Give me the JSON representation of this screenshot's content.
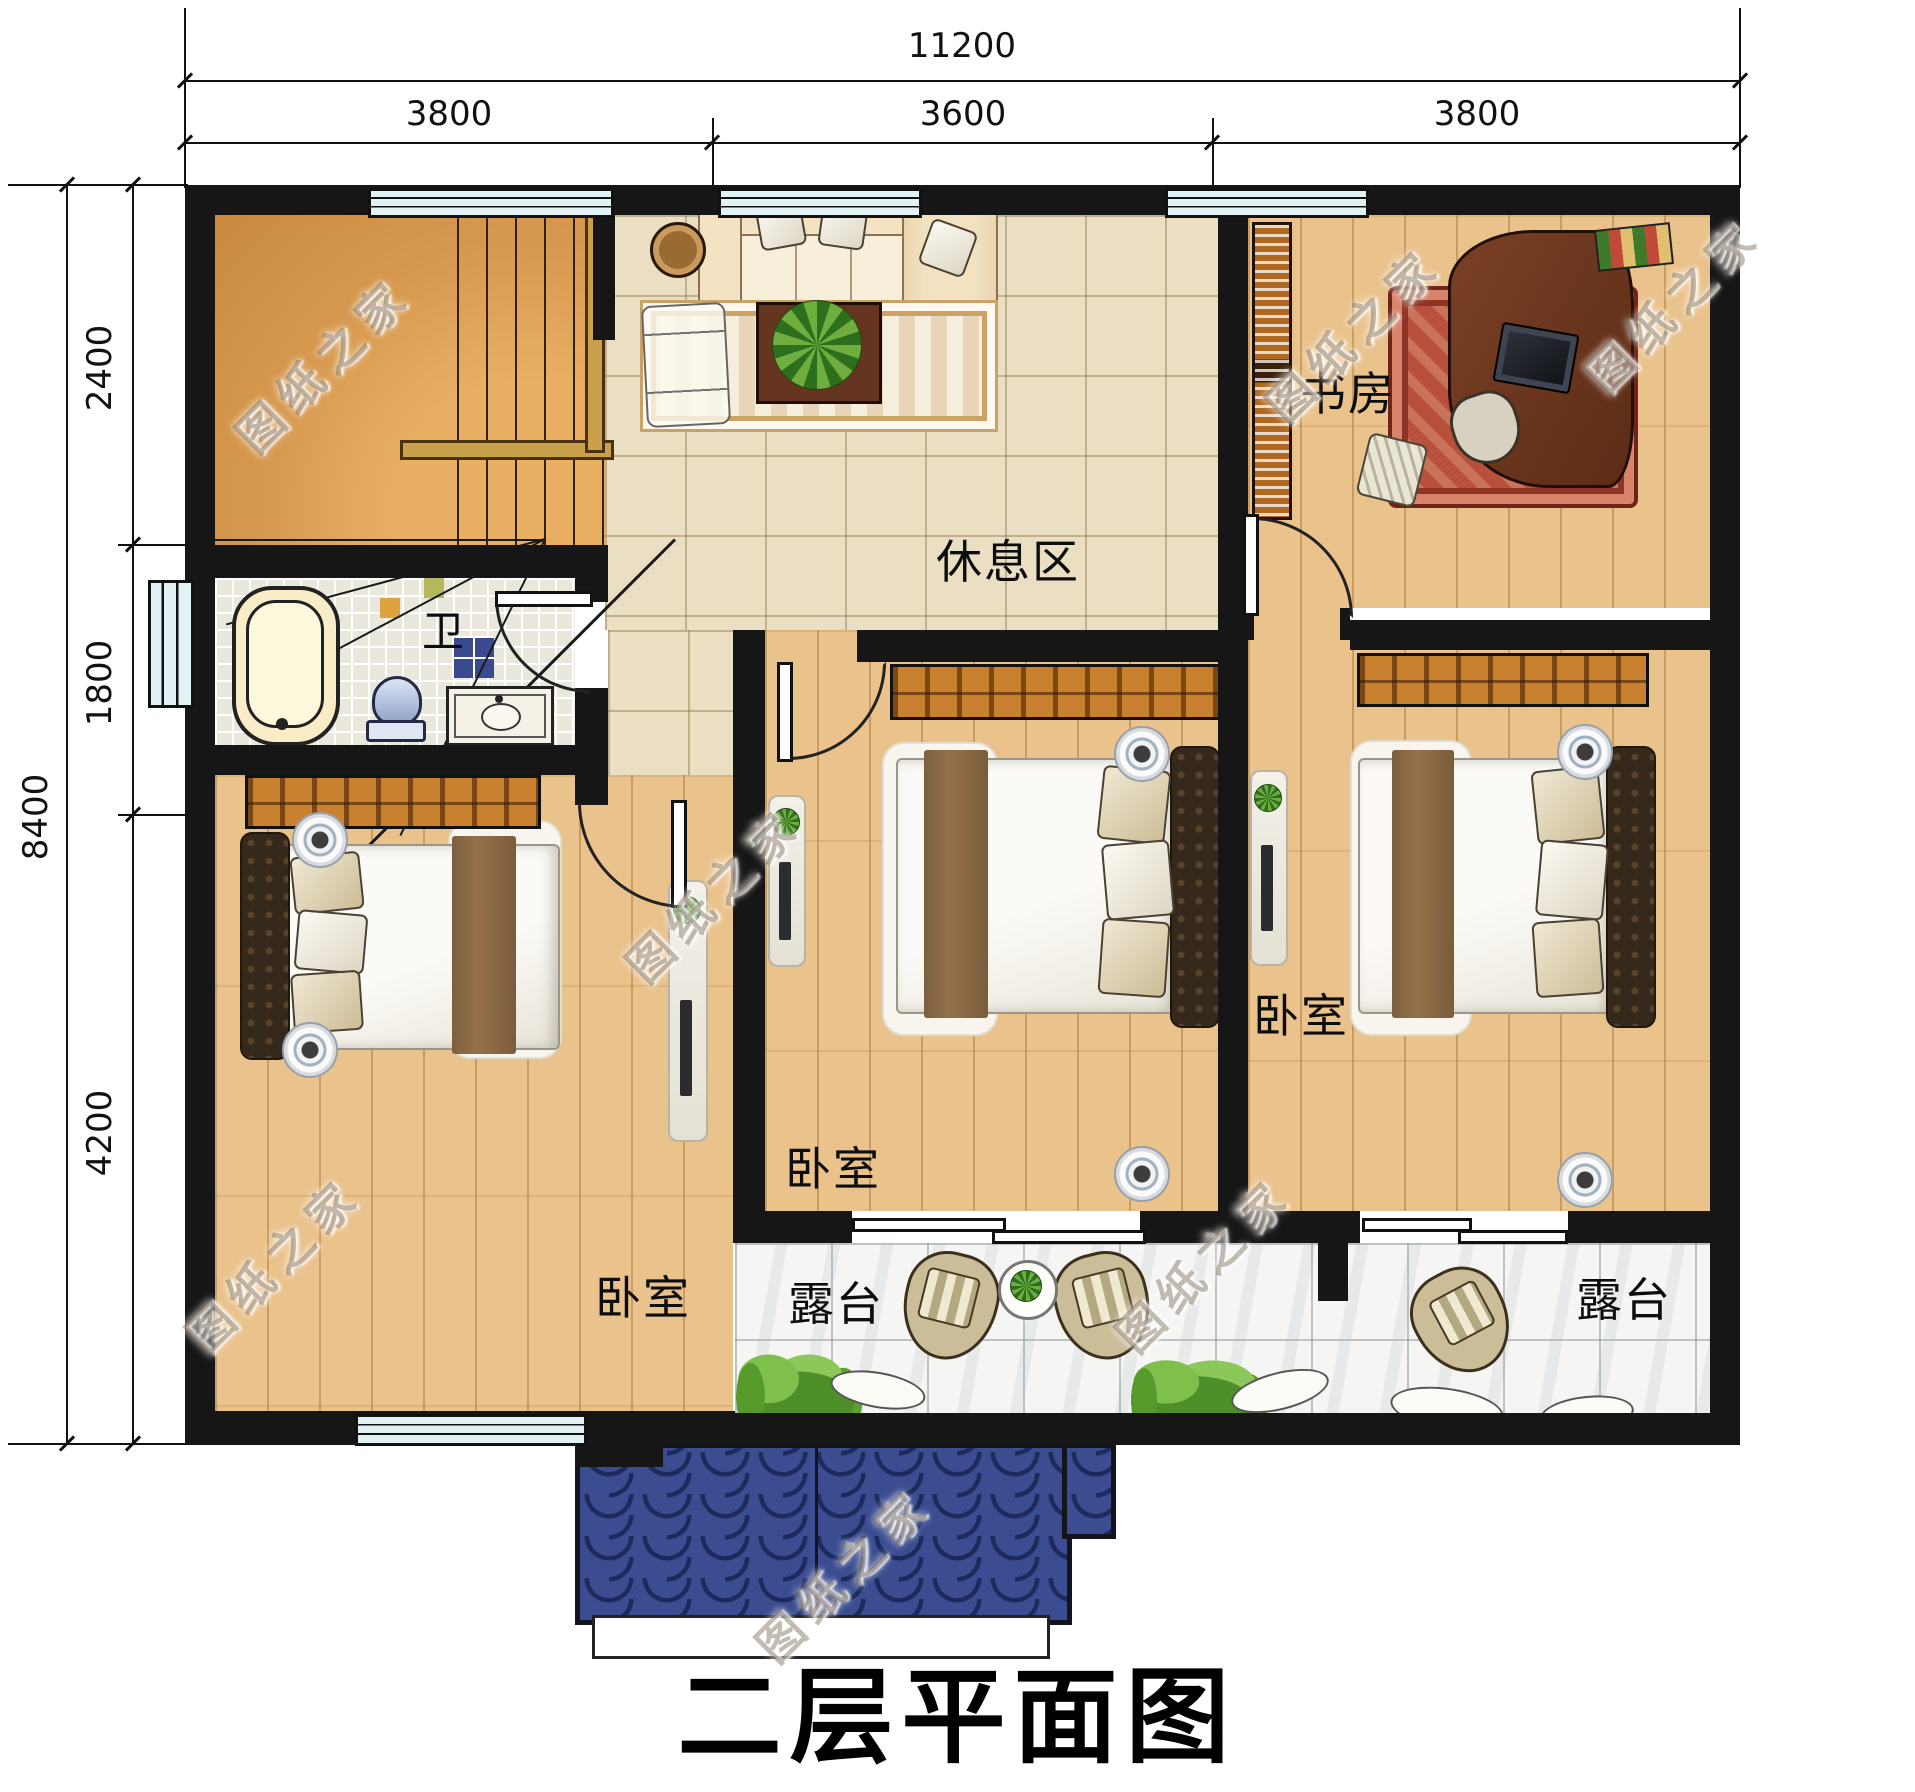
{
  "title": "二层平面图",
  "watermark": {
    "text": "图纸之家"
  },
  "dimensions": {
    "top": {
      "total": "11200",
      "segments": [
        "3800",
        "3600",
        "3800"
      ]
    },
    "left": {
      "total": "8400",
      "segments": [
        "2400",
        "1800",
        "4200"
      ]
    }
  },
  "rooms": {
    "study": "书房",
    "rest_area": "休息区",
    "bath": "卫",
    "bedroom_left": "卧室",
    "bedroom_middle": "卧室",
    "bedroom_right": "卧室",
    "terrace_left": "露台",
    "terrace_right": "露台"
  },
  "colors": {
    "wall": "#161616",
    "wood_floor": "#eac28c",
    "tile_floor": "#eadfc2",
    "mosaic_floor": "#eae7dc",
    "terrace_floor": "#f5f6f4",
    "window_glass": "#e2f2f4",
    "wardrobe": "#c9812f",
    "bed_runner": "#8b6b46",
    "headboard": "#35291c",
    "roof_blue": "#3b4d90",
    "greenery": "#6fae3e",
    "study_rug_red": "#b8503c"
  }
}
